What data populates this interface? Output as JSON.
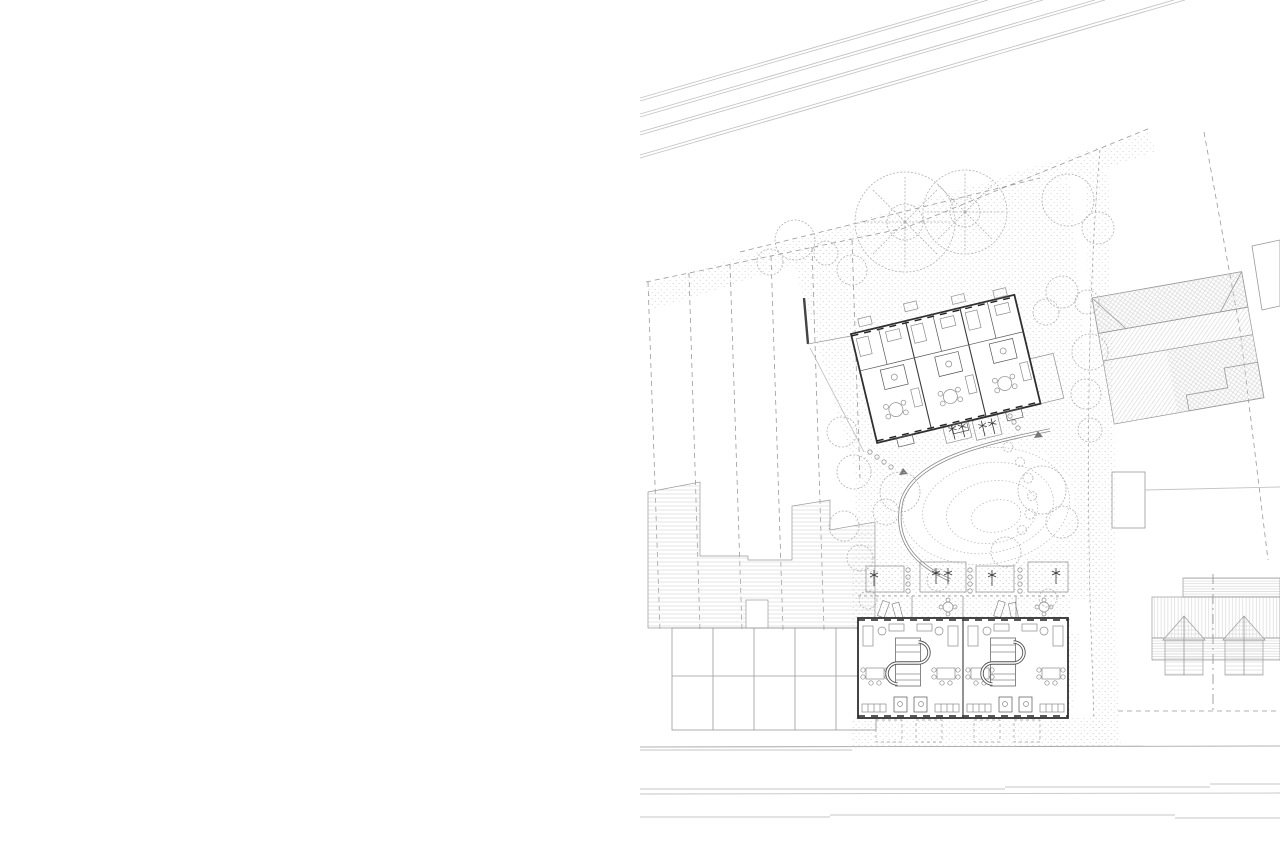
{
  "meta": {
    "artifact": "architectural-site-plan",
    "view": "top-down ground floor plan",
    "drawing_extent": "right half of sheet; left half blank"
  },
  "palette": {
    "background": "#ffffff",
    "building_outline": "#2f2f2f",
    "wall_medium": "#555555",
    "line_light": "#c4c4c4",
    "line_medium": "#9a9a9a",
    "boundary_dash": "#999999",
    "hatch": "#d9d9d9",
    "stipple": "#c9c9c9",
    "contour": "#b8b8b8",
    "tree": "#b0b0b0"
  },
  "features": [
    {
      "id": "railway-corridor",
      "kind": "parallel-lines",
      "label": "Railway / road corridor, 8 parallel lines sloping up to the right",
      "count_lines": 8
    },
    {
      "id": "site-boundary",
      "kind": "dashed-line",
      "label": "Dashed site boundary parallel to corridor, turning south at east side"
    },
    {
      "id": "garden-parcels",
      "kind": "dashed-strips",
      "label": "Long narrow garden parcels, 5 strips with dashed dividers",
      "count_strips": 5
    },
    {
      "id": "allotment-buildings",
      "kind": "hatched-region",
      "label": "Stepped row of outbuildings, horizontal hatch"
    },
    {
      "id": "shed-grid",
      "kind": "hatched-grid",
      "label": "Grid of garden sheds, vertical hatch, 2 rows x 5 columns"
    },
    {
      "id": "upper-apartment-building",
      "kind": "floor-plan",
      "label": "Apartment building rotated ~13°, 3 units with furniture",
      "units_visible": 3
    },
    {
      "id": "dryer-plots",
      "kind": "symbol-plots",
      "label": "Two small plots with rotary-dryer symbols"
    },
    {
      "id": "central-garden",
      "kind": "landscape",
      "label": "Garden with C-shaped double-line path, dotted mound contours, lawn"
    },
    {
      "id": "lower-terraced-houses",
      "kind": "floor-plan",
      "label": "Terrace of 4 dwellings with S-shaped stairs",
      "units_visible": 4
    },
    {
      "id": "rear-gardens",
      "kind": "landscape",
      "label": "Rear gardens with dryer plots, stepping stones, terraces with loungers and tables"
    },
    {
      "id": "entrance-stoops",
      "kind": "dashed-rects",
      "label": "Four dashed entrance stoops on street side"
    },
    {
      "id": "east-street",
      "kind": "verge",
      "label": "North-south street with stippled verges"
    },
    {
      "id": "existing-house-east",
      "kind": "roof-plan",
      "label": "Large existing hipped roof, diagonal hatch, rotated ~10°"
    },
    {
      "id": "garage-east",
      "kind": "roof-plan",
      "label": "Small outbuilding roof, fine horizontal hatch"
    },
    {
      "id": "existing-houses-southeast",
      "kind": "roof-plan",
      "label": "Pair of gabled houses with hatched roofs and dash-dot axis"
    },
    {
      "id": "south-road",
      "kind": "parallel-lines",
      "label": "Horizontal road edge lines along sheet bottom",
      "count_lines": 4
    },
    {
      "id": "trees",
      "kind": "vegetation",
      "label": "Branched large trees and dashed-outline canopy trees throughout"
    }
  ]
}
